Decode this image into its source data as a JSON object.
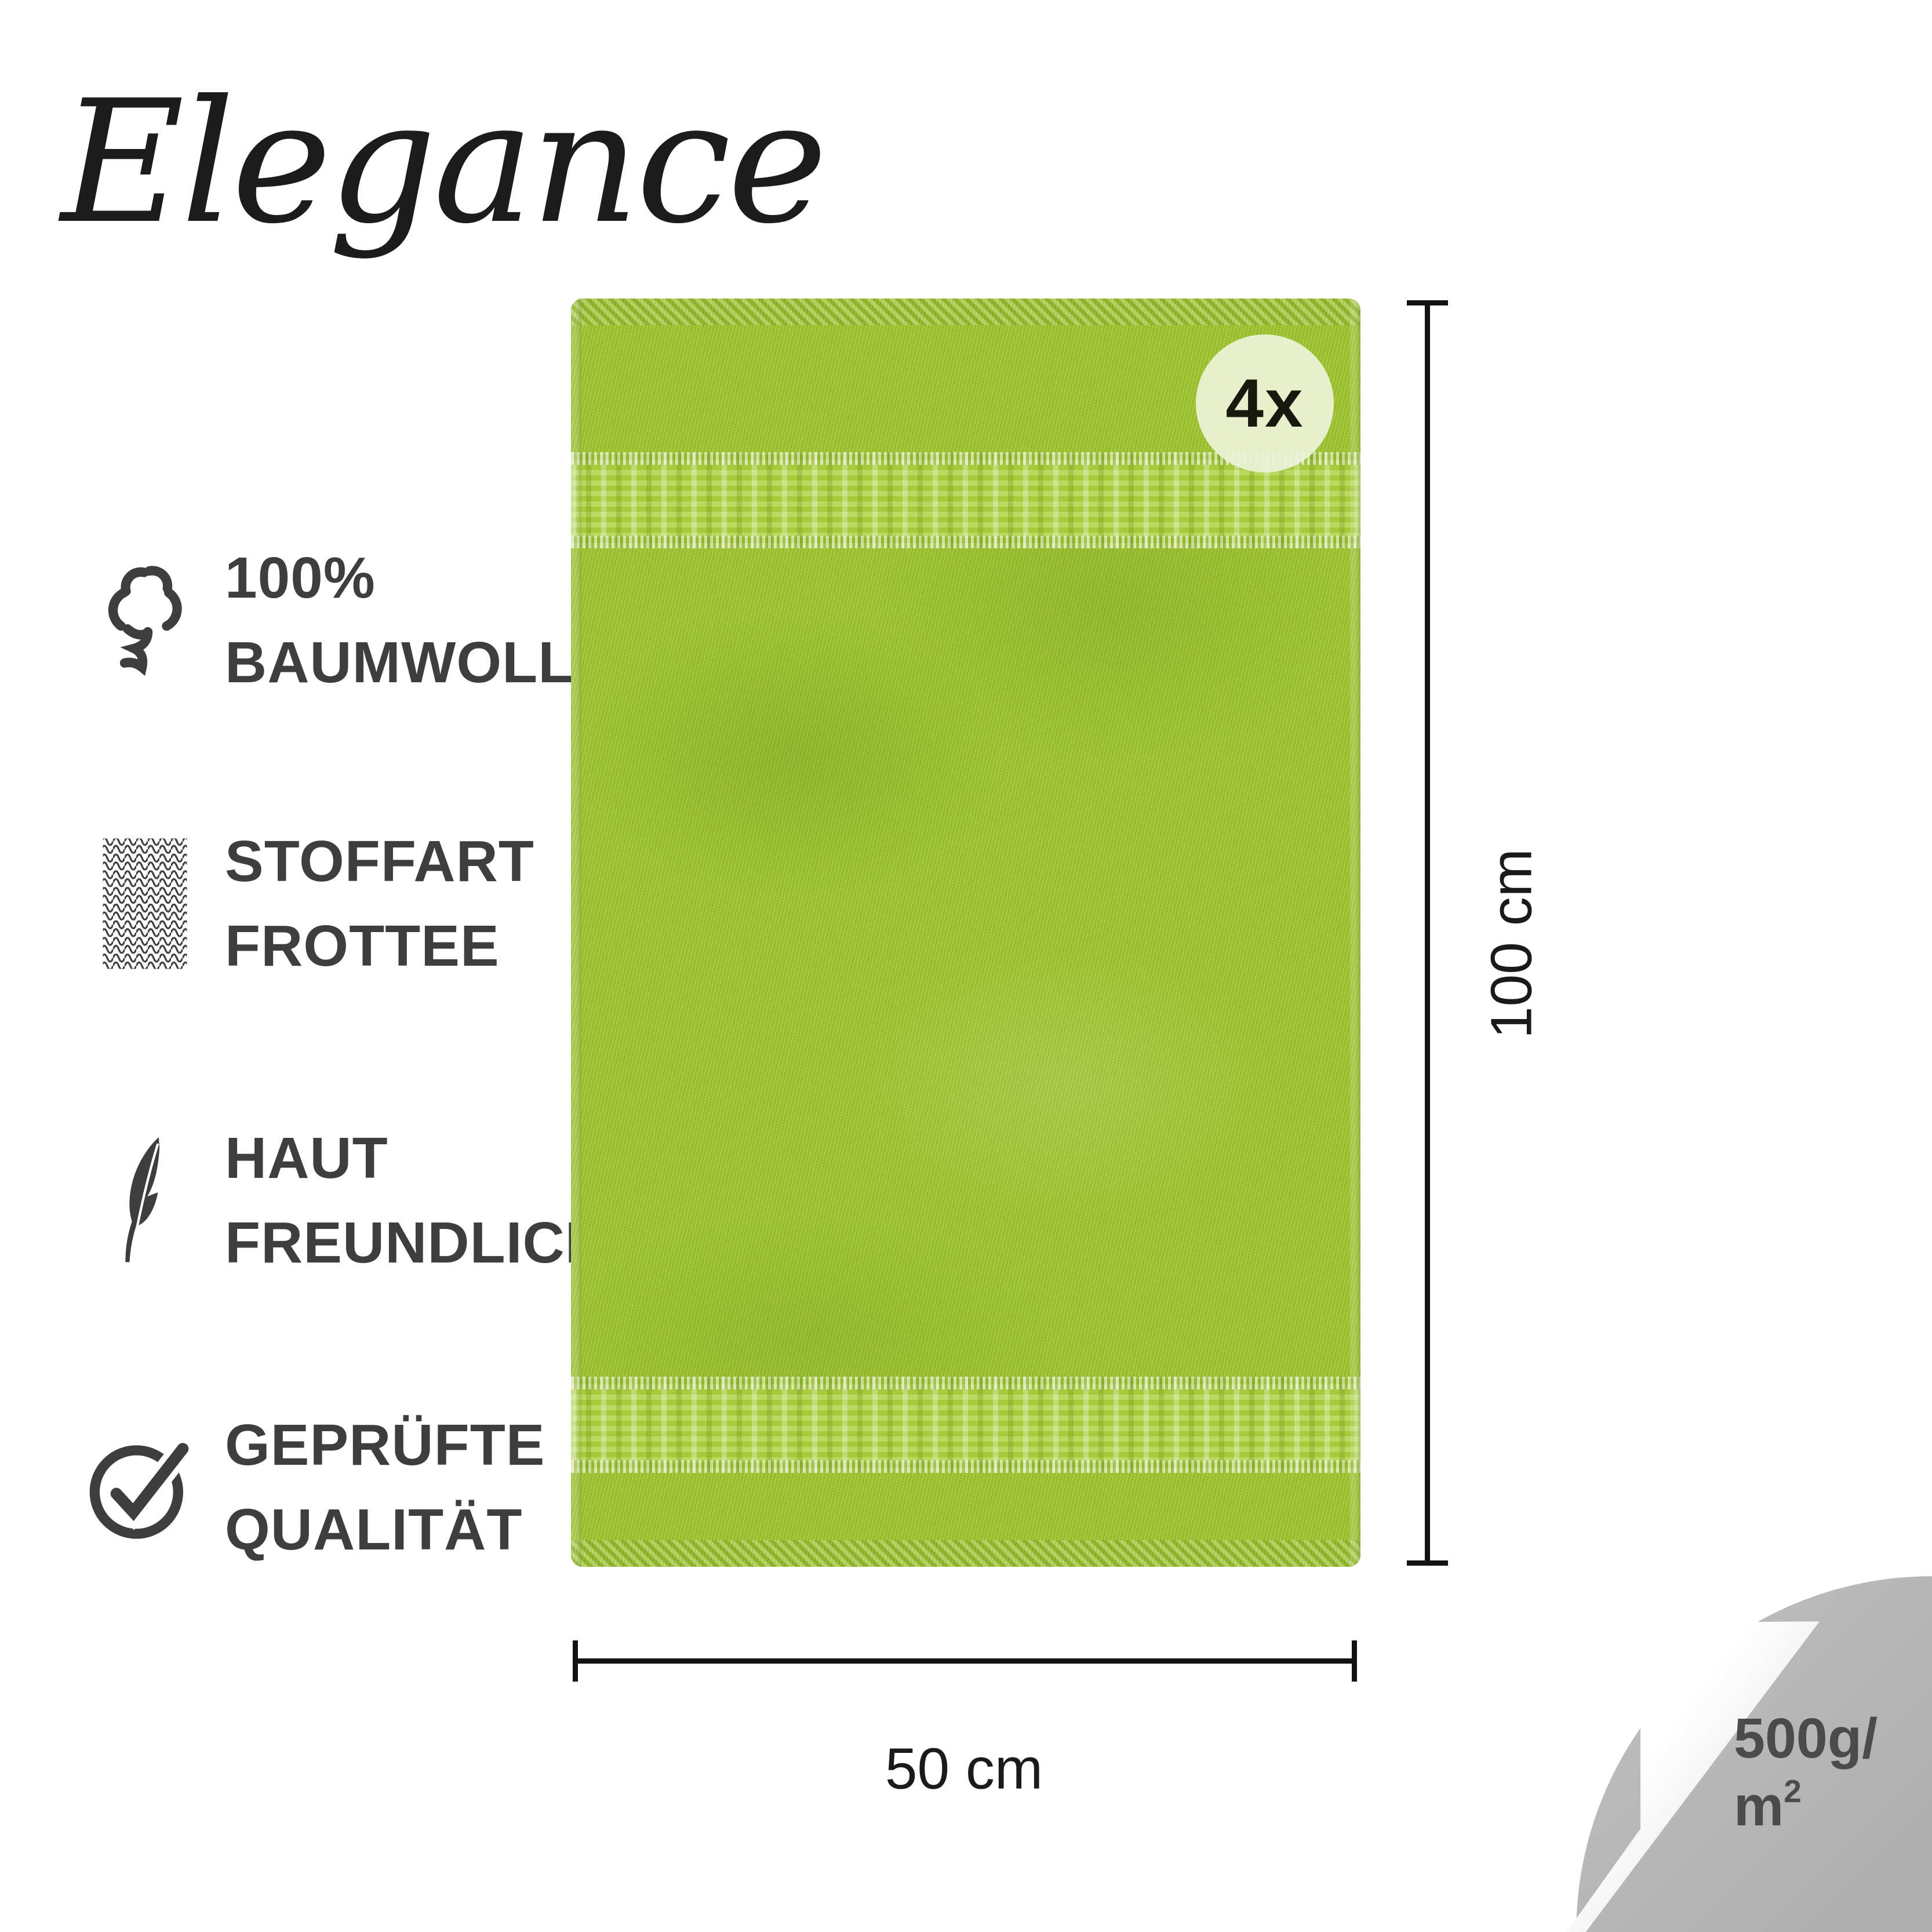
{
  "brand": {
    "logo": "Elegance"
  },
  "features": [
    {
      "icon": "cotton-icon",
      "lines": [
        "100%",
        "BAUMWOLLE"
      ]
    },
    {
      "icon": "fabric-texture-icon",
      "lines": [
        "STOFFART",
        "FROTTEE"
      ]
    },
    {
      "icon": "feather-icon",
      "lines": [
        "HAUT",
        "FREUNDLICH"
      ]
    },
    {
      "icon": "quality-check-icon",
      "lines": [
        "GEPRÜFTE",
        "QUALITÄT"
      ]
    }
  ],
  "product": {
    "badge_count": "4x",
    "height_label": "100 cm",
    "width_label": "50 cm",
    "weight_line1": "500g/",
    "weight_base": "m",
    "weight_sup": "2"
  },
  "colors": {
    "towel_green": "#9fc52e",
    "band_green": "#aed242",
    "icon_text_gray": "#3e3e3e",
    "dimension_black": "#121212",
    "corner_gray": "#b6b6b6",
    "corner_text_gray": "#4b4b4b",
    "badge_bg": "#eef3da",
    "logo_black": "#1c1c1c"
  }
}
